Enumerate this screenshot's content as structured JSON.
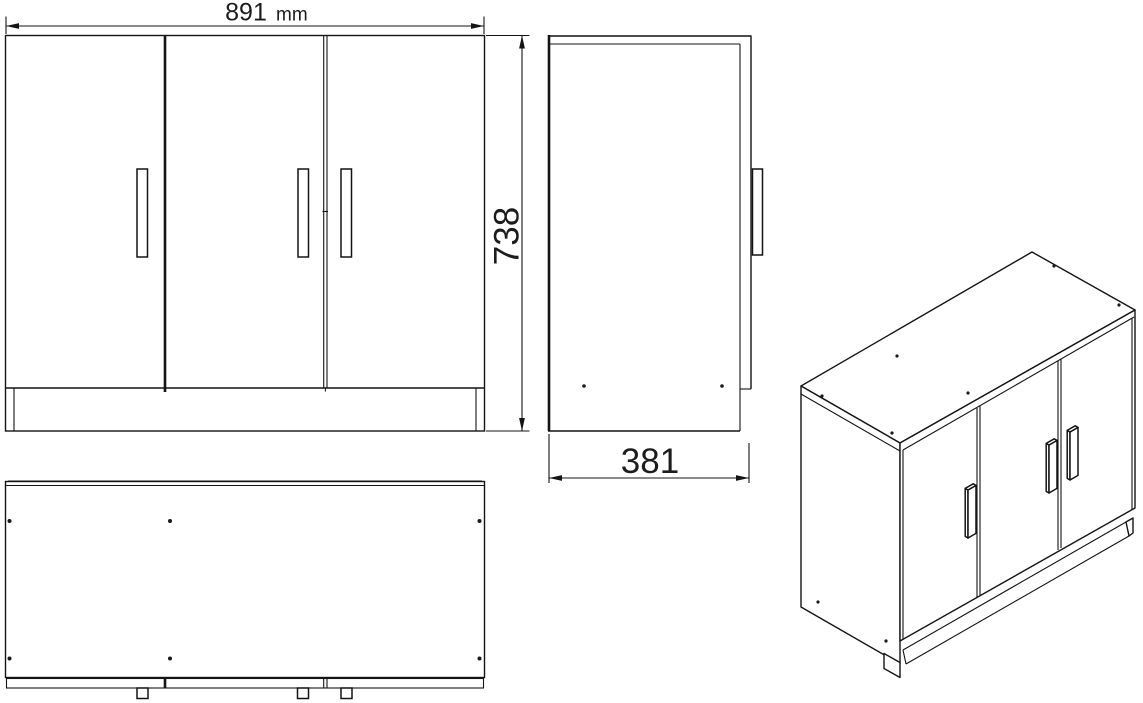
{
  "drawing": {
    "kind": "cabinet technical drawing",
    "door_count": 3,
    "line_color": "#141414",
    "background": "#ffffff",
    "dim": {
      "width": "891",
      "width_unit": "mm",
      "height": "738",
      "depth": "381"
    }
  }
}
